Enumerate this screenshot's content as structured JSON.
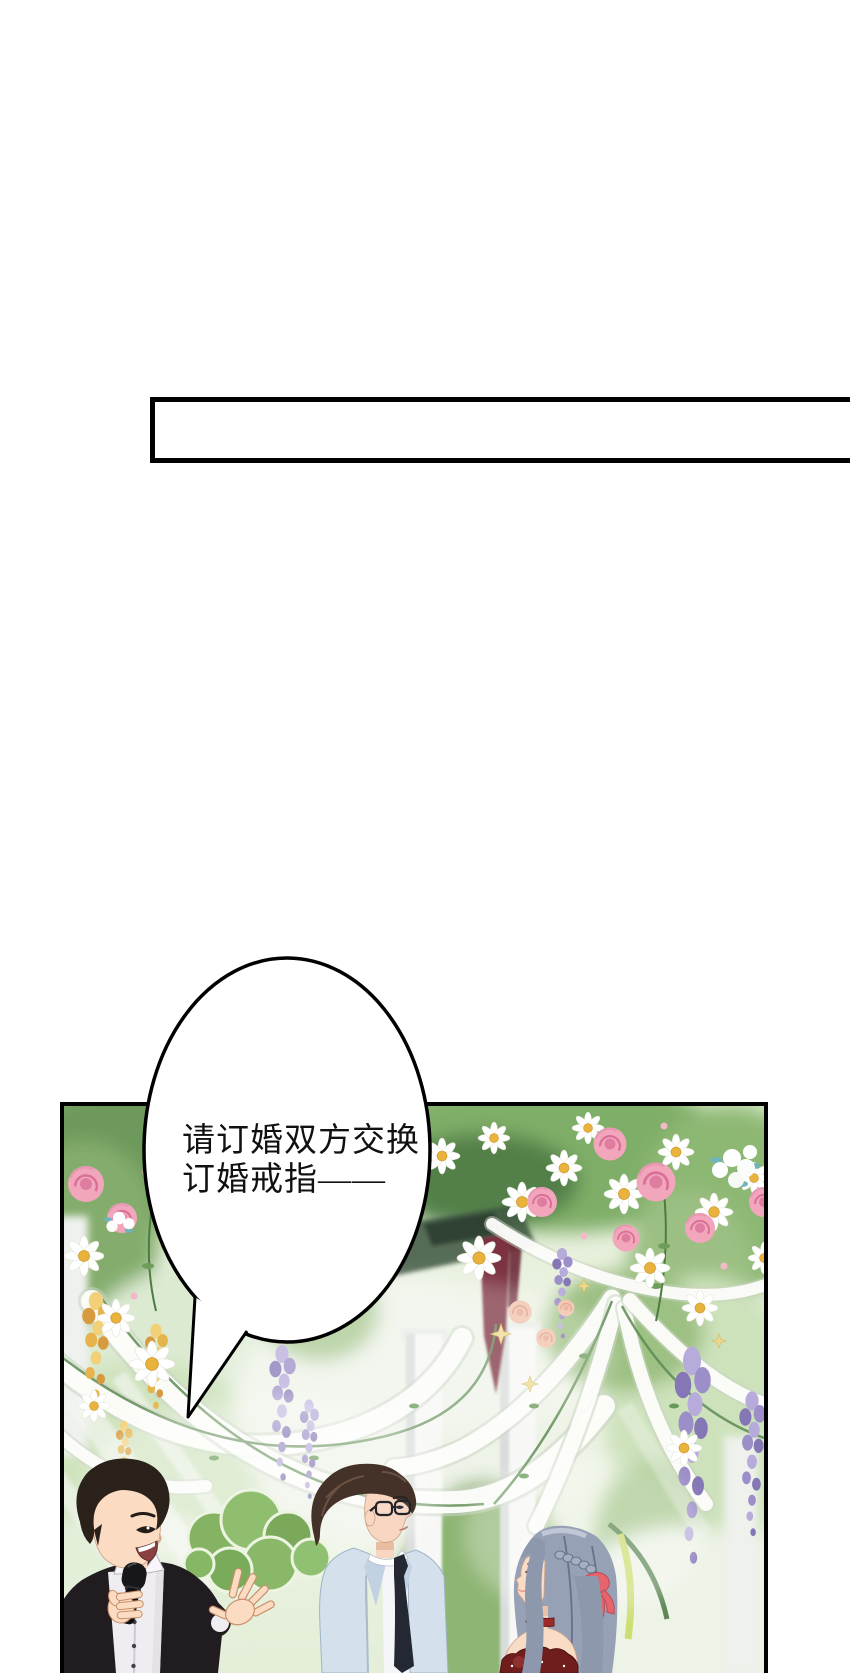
{
  "page": {
    "width": 850,
    "height": 1673,
    "background": "#ffffff"
  },
  "top_panel": {
    "fill": "#ffffff",
    "border_color": "#000000"
  },
  "main_panel": {
    "border_color": "#000000"
  },
  "speech_bubble": {
    "fill": "#ffffff",
    "stroke": "#000000",
    "text_color": "#111111",
    "line1": "请订婚双方交换",
    "line2": "订婚戒指——"
  },
  "scene": {
    "characters": [
      {
        "id": "host-with-microphone",
        "suit": "#211c20",
        "shirt": "#efedf2",
        "hair": "#2b211b",
        "skin": "#fbdcc3"
      },
      {
        "id": "groom-in-light-blue-suit",
        "suit": "#d4e0eb",
        "tie": "#232832",
        "hair": "#443128",
        "glasses": "#23232a",
        "skin": "#f8d6c2"
      },
      {
        "id": "bride-in-red-dress",
        "hair": "#97a1b5",
        "dress": "#6f1d1d",
        "choker": "#9c2a2a",
        "hair_ribbon": "#e6646c",
        "skin": "#f9dcc6"
      }
    ],
    "palette": {
      "foliage_dark": "#53804a",
      "foliage_mid": "#7fae68",
      "foliage_light": "#cfe4b6",
      "daisy_petal": "#ffffff",
      "daisy_center": "#e8b23c",
      "rose_pink": "#f2a6bc",
      "rose_deep": "#d96f96",
      "peach_rose": "#f0c0aa",
      "wisteria_purple": "#9c8ec8",
      "laburnum_yellow": "#e6b44c",
      "ribbon_white": "#fdfdfb",
      "column_white": "#f7f8f5",
      "pennant_maroon": "#7c3140",
      "teal_accent": "#6fb4ba",
      "sparkle_gold": "#ecd98e"
    }
  }
}
